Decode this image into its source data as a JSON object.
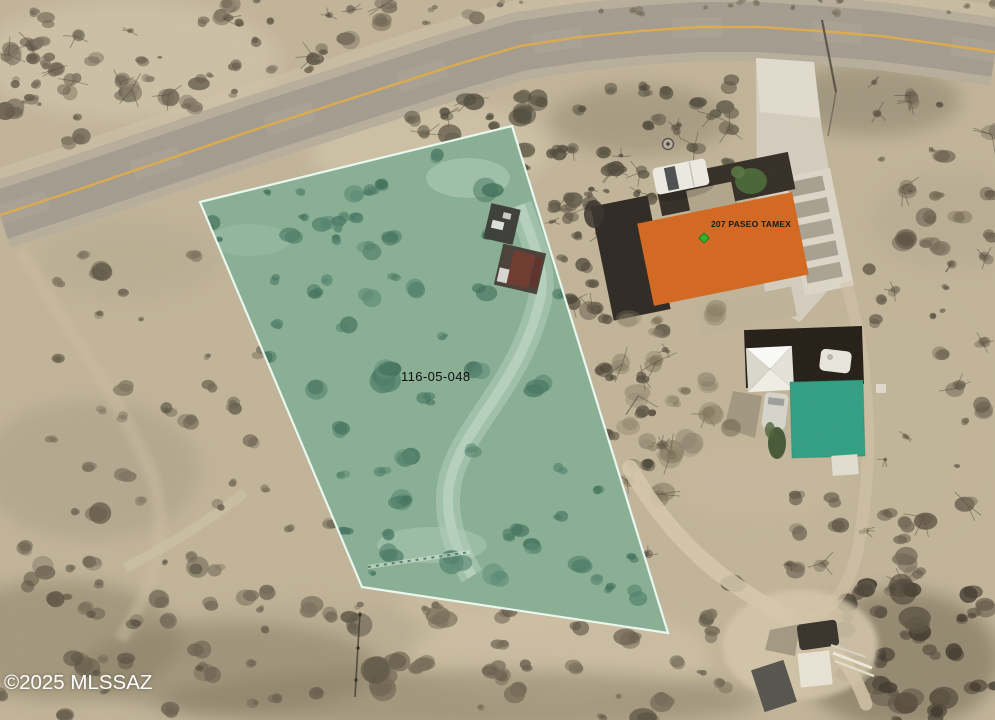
{
  "map": {
    "copyright": "©2025 MLSSAZ",
    "parcel": {
      "id_label": "116-05-048",
      "fill_color": "#4aa58c",
      "border_color": "#eefff8"
    },
    "address_overlay": {
      "label": "207 PASEO TAMEX",
      "building_color": "#d4671f",
      "marker_color": "#2eb832"
    },
    "outbuilding": {
      "fill_color": "#2f9f83"
    },
    "road": {
      "centerline_color": "#ddab4e"
    }
  }
}
